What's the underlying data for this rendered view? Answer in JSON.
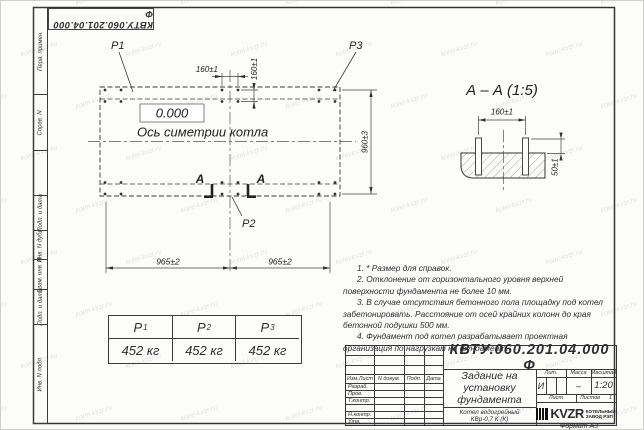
{
  "watermark": {
    "text": "kotel-kvzr.ru"
  },
  "frame": {
    "top_doc_number": "КВТУ.060.201.04.000  Ф",
    "format_note": "Формат А3",
    "margins": [
      "Перв. примен.",
      "Справ. N",
      "Подп. и дата",
      "Инв. N дубл.",
      "Взам. инв. N",
      "Подп. и дата",
      "Инв. N подл."
    ]
  },
  "plan": {
    "labels": {
      "p1": "Р1",
      "p2": "Р2",
      "p3": "Р3",
      "section": "А"
    },
    "elevation": "0.000",
    "axis": "Ось симетрии котла",
    "dims": {
      "bolt_x": "160±1",
      "bolt_y": "160±1",
      "height": "960±3",
      "span_left": "965±2",
      "span_right": "965±2"
    }
  },
  "section": {
    "title": "А – А (1:5)",
    "dims": {
      "spacing": "160±1",
      "protrusion": "50±1"
    }
  },
  "notes": [
    "1. * Размер для справок.",
    "2. Отклонение от горизонтального уровня верхней поверхности фундамента не более 10 мм.",
    "3. В случае отсутствия бетонного пола площадку под котел забетонировать. Расстояние от осей крайних колонн до края бетонной подушки 500 мм.",
    "4. Фундамент под котел разрабатывает проектная организация по нагрузкам на фундамент."
  ],
  "loads_table": {
    "headers": [
      {
        "name": "Р",
        "sub": "1"
      },
      {
        "name": "Р",
        "sub": "2"
      },
      {
        "name": "Р",
        "sub": "3"
      }
    ],
    "values": [
      "452 кг",
      "452 кг",
      "452 кг"
    ]
  },
  "title_block": {
    "doc_number": "КВТУ.060.201.04.000  Ф",
    "title": "Задание на установку фундамента",
    "product": "Котел водогрейный КВр-0,7 К (К)",
    "columns": {
      "izm": "Изм.Лист",
      "doc": "N докум.",
      "sign": "Подп.",
      "date": "Дата"
    },
    "rows": [
      "Разраб.",
      "Пров.",
      "Т.контр.",
      "",
      "Н.контр.",
      "Утв."
    ],
    "lit_label": "Лит.",
    "mass_label": "Масса",
    "scale_label": "Масштаб",
    "lit_value": "И",
    "mass_value": "–",
    "scale_value": "1:20",
    "sheet_label": "Лист",
    "sheets_label": "Листов",
    "sheets_value": "1",
    "company": {
      "name": "KVZR",
      "line1": "КОТЕЛЬНЫЙ",
      "line2": "ЗАВОД РЭП"
    }
  }
}
